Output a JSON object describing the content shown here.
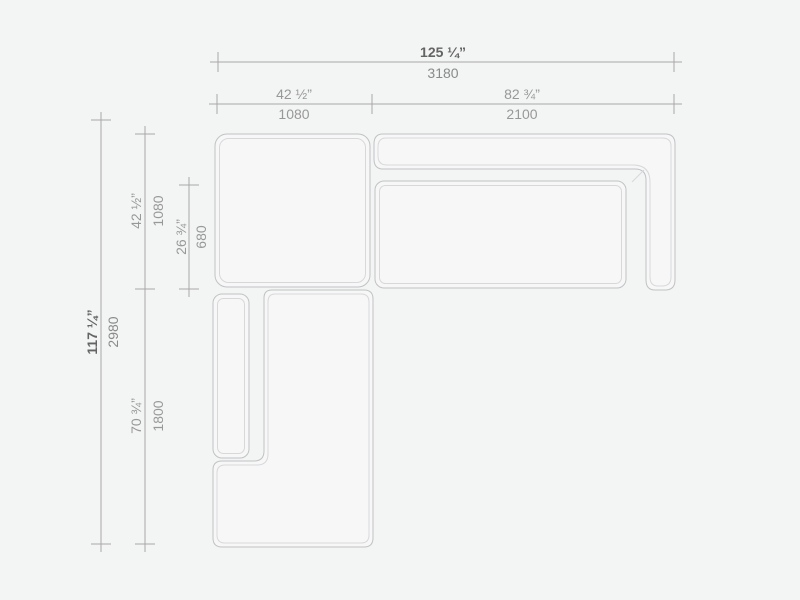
{
  "colors": {
    "background": "#f3f4f4",
    "module_fill": "#f7f7f8",
    "outline": "#c0c2c4",
    "outline_inner": "#d7d8da",
    "dimension_line": "#a8a8a8",
    "label_primary": "#646464",
    "label_secondary": "#8a8a8a",
    "label_sub": "#989898"
  },
  "dimensions": {
    "overall_width": {
      "inches": "125 ¼”",
      "mm": "3180"
    },
    "left_module_width": {
      "inches": "42 ½”",
      "mm": "1080"
    },
    "right_module_width": {
      "inches": "82 ¾”",
      "mm": "2100"
    },
    "overall_depth": {
      "inches": "117 ¼”",
      "mm": "2980"
    },
    "left_module_depth": {
      "inches": "42 ½”",
      "mm": "1080"
    },
    "seat_depth": {
      "inches": "26 ¾”",
      "mm": "680"
    },
    "chaise_length": {
      "inches": "70 ¾”",
      "mm": "1800"
    }
  }
}
